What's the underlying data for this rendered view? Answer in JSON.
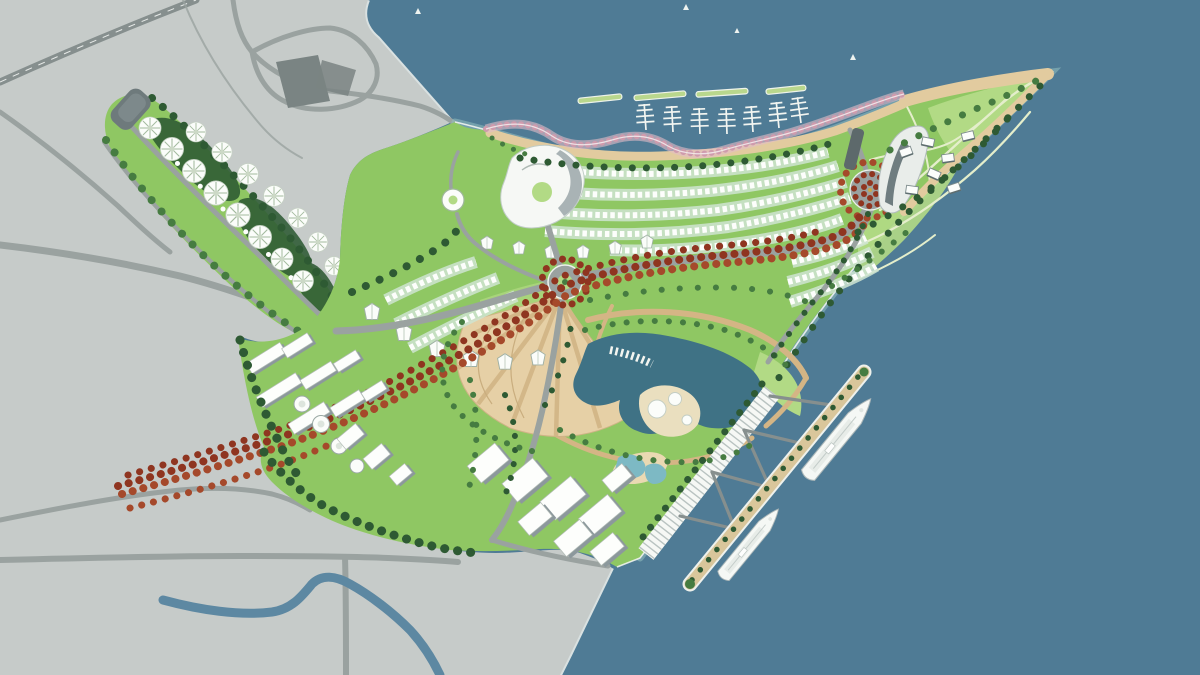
{
  "meta": {
    "title": "Coastal resort master plan — aerial site rendering",
    "description": "Bird's-eye master plan of a triangular waterfront peninsula development surrounded by sea, attached to a gray existing-city mainland; features a marina with floating docks and breakwaters, a red flowering-tree boulevard linking two roundabout plazas, villa rows, a central lake with dome pavilions, terraced sand fan, a cruise pier with two ships, and a flower-shaped pavilion resort arm."
  },
  "palette": {
    "ocean": "#4f7b95",
    "oceanDeep": "#47708a",
    "mainland": "#c6cbc9",
    "roadGray": "#9aa2a0",
    "roadDark": "#868f8e",
    "blockDark": "#7a8483",
    "river": "#5d88a2",
    "siteGreen": "#8fc763",
    "lawnLight": "#b2da85",
    "lawnPale": "#cfe5a8",
    "treeDark": "#2e5a33",
    "treeMid": "#467c41",
    "treeRed": "#8f3520",
    "treeRedLt": "#a5492b",
    "sand": "#e2cb9f",
    "sandDeep": "#d4b585",
    "lake": "#3f7285",
    "poolBlue": "#7db9c4",
    "pink": "#cf9bad",
    "pinkLt": "#e3bcc8",
    "mint": "#cfe5d2",
    "pathLt": "#e4eecb",
    "quay": "#eef1ee",
    "shallow": "#93c0c0"
  },
  "features": {
    "ocean": "sea water surrounding peninsula",
    "mainland": "existing city land, gray with road network",
    "river": "canal crossing mainland at south-west",
    "marina": {
      "label": "north marina",
      "docks": 7,
      "breakwaters": 4,
      "promenade": "pink flowering-tree promenade"
    },
    "roundabouts": {
      "count": 2,
      "label": "tree-ringed circular plazas"
    },
    "red_boulevard": "avenue of red-canopy trees from mainland through site to north-east roundabout",
    "flower_resort_arm": {
      "label": "north-west resort arm",
      "flower_pavilions": 15,
      "tower": "gray tower at tip"
    },
    "lake": {
      "label": "central lake",
      "dome_pavilions": 3,
      "boardwalk": "stepped boardwalk on north-west edge"
    },
    "sand_fan": "terraced radial sand garden south of central roundabout",
    "villa_rows": "arcs of white villa rows across north and east districts",
    "west_district": "white apartment slabs and round tank pavilions",
    "south_commercial": "large white flat-roof blocks near south shore",
    "cruise_pier": {
      "label": "south-east pier",
      "ships": 2,
      "quay": "hatched linear quay building"
    },
    "ne_park": "lawn park with tent pavilions and sail-shaped landmark building",
    "boats": 4
  }
}
